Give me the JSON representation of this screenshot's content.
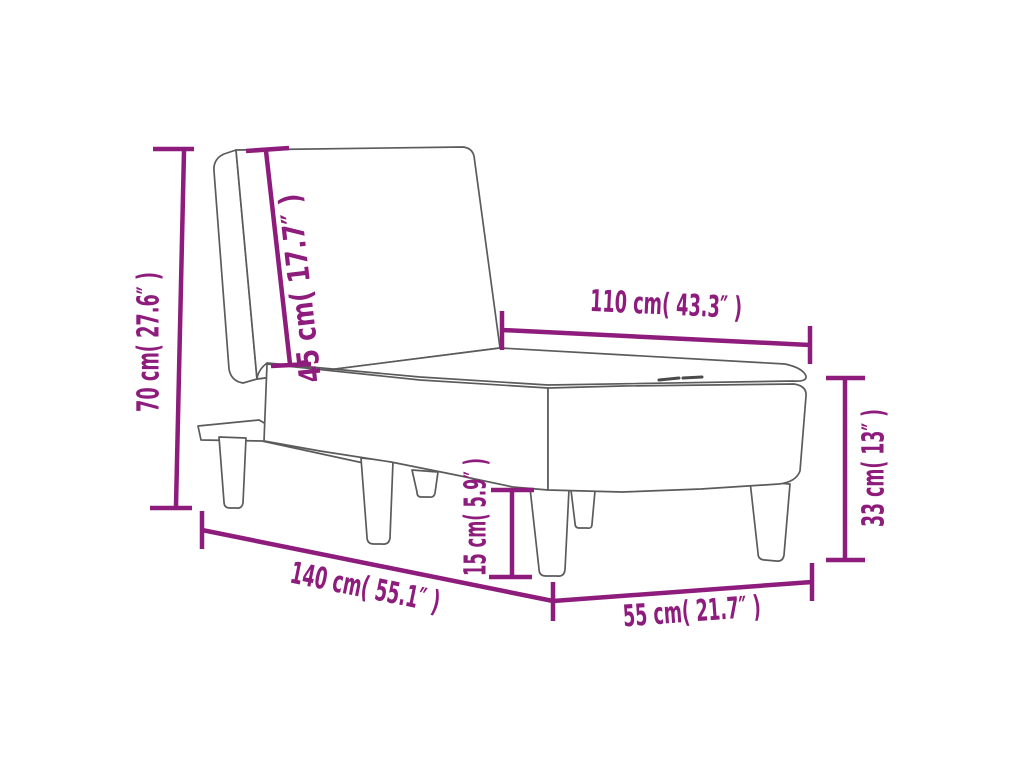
{
  "diagram": {
    "subject": "chaise-longue-dimension-drawing",
    "background_color": "#ffffff",
    "outline_color": "#5b5b5b",
    "accent_color": "#8e1c7c",
    "dimensions": [
      {
        "id": "total-height",
        "label": "70 cm( 27.6″ )",
        "cm": 70,
        "inches": 27.6
      },
      {
        "id": "backrest-length",
        "label": "45 cm( 17.7″ )",
        "cm": 45,
        "inches": 17.7
      },
      {
        "id": "seat-length",
        "label": "110 cm( 43.3″ )",
        "cm": 110,
        "inches": 43.3
      },
      {
        "id": "seat-height",
        "label": "33 cm( 13″ )",
        "cm": 33,
        "inches": 13
      },
      {
        "id": "clearance",
        "label": "15 cm( 5.9″ )",
        "cm": 15,
        "inches": 5.9
      },
      {
        "id": "total-length",
        "label": "140 cm( 55.1″ )",
        "cm": 140,
        "inches": 55.1
      },
      {
        "id": "total-width",
        "label": "55 cm( 21.7″ )",
        "cm": 55,
        "inches": 21.7
      }
    ]
  }
}
